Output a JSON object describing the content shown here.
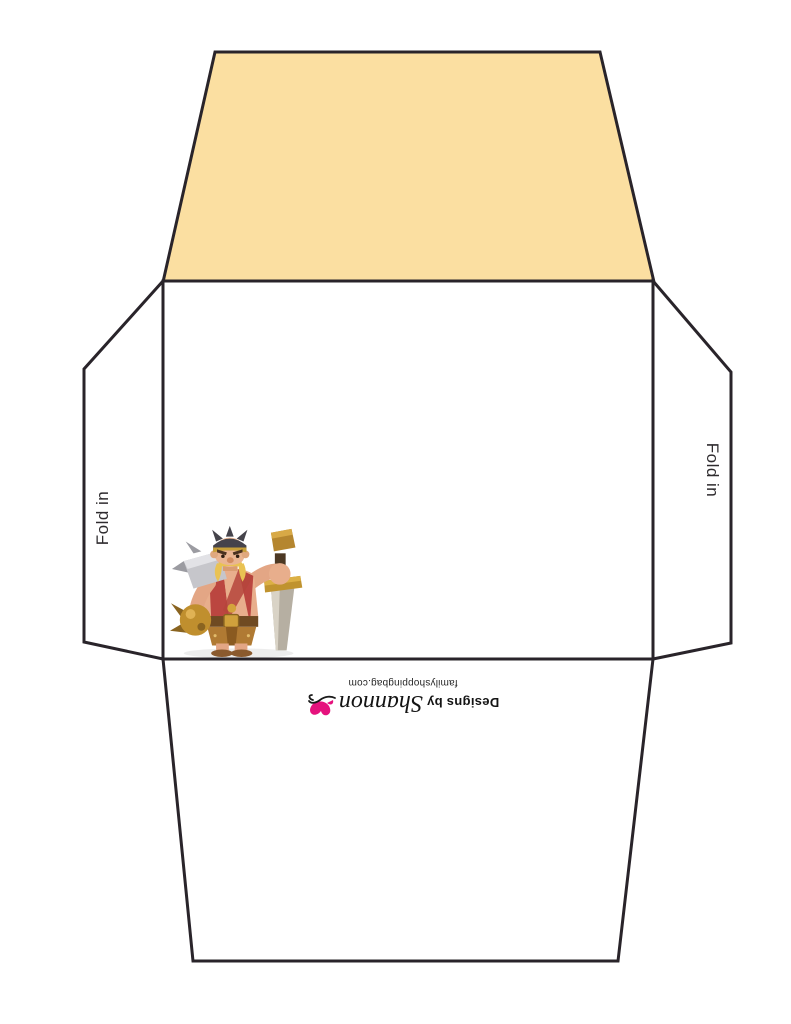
{
  "labels": {
    "fold_in_left": "Fold in",
    "fold_in_right": "Fold in"
  },
  "branding": {
    "prefix": "Designs by",
    "script_name": "Shannon",
    "website": "familyshoppingbag.com",
    "logo_icon": "butterfly-icon"
  },
  "illustration": "barbarian-king",
  "colors": {
    "top_flap_fill": "#fbdfa1",
    "outline": "#29242a",
    "brand_pink": "#e5127d",
    "label_text": "#2e2b2e",
    "brand_text": "#141414"
  }
}
